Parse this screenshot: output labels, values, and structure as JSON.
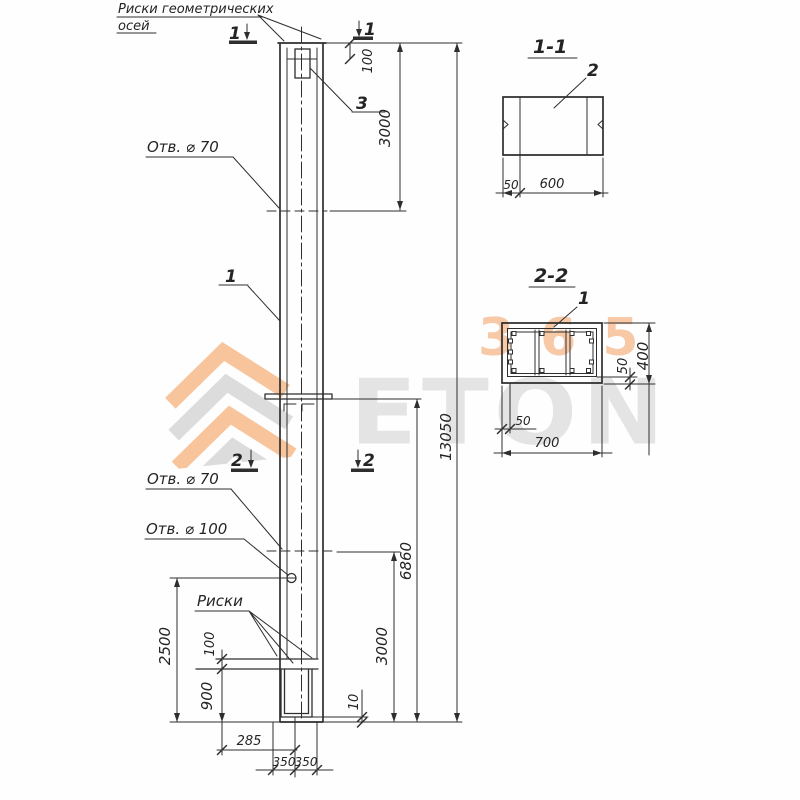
{
  "note": {
    "line1": "Риски геометрических",
    "line2": "осей"
  },
  "labels": {
    "part1": "1",
    "part3": "3",
    "riski": "Риски",
    "hole70_top": "Отв. ⌀ 70",
    "hole70_mid": "Отв. ⌀ 70",
    "hole100": "Отв. ⌀ 100"
  },
  "cuts": {
    "c1": "1",
    "c2": "2"
  },
  "dims": {
    "d100_top": "100",
    "d3000_top": "3000",
    "d13050": "13050",
    "d6860": "6860",
    "d3000_bot": "3000",
    "d2500": "2500",
    "d100_left": "100",
    "d900": "900",
    "d10": "10",
    "d285": "285",
    "d350_l": "350",
    "d350_r": "350"
  },
  "section11": {
    "title": "1-1",
    "part": "2",
    "d50": "50",
    "d600": "600"
  },
  "section22": {
    "title": "2-2",
    "part": "1",
    "d50_right": "50",
    "d400": "400",
    "d50_bottom": "50",
    "d700": "700"
  },
  "watermark": {
    "brand": "ETON",
    "number": "365",
    "orange": "#f5b480",
    "gray": "#d7d7d7"
  }
}
